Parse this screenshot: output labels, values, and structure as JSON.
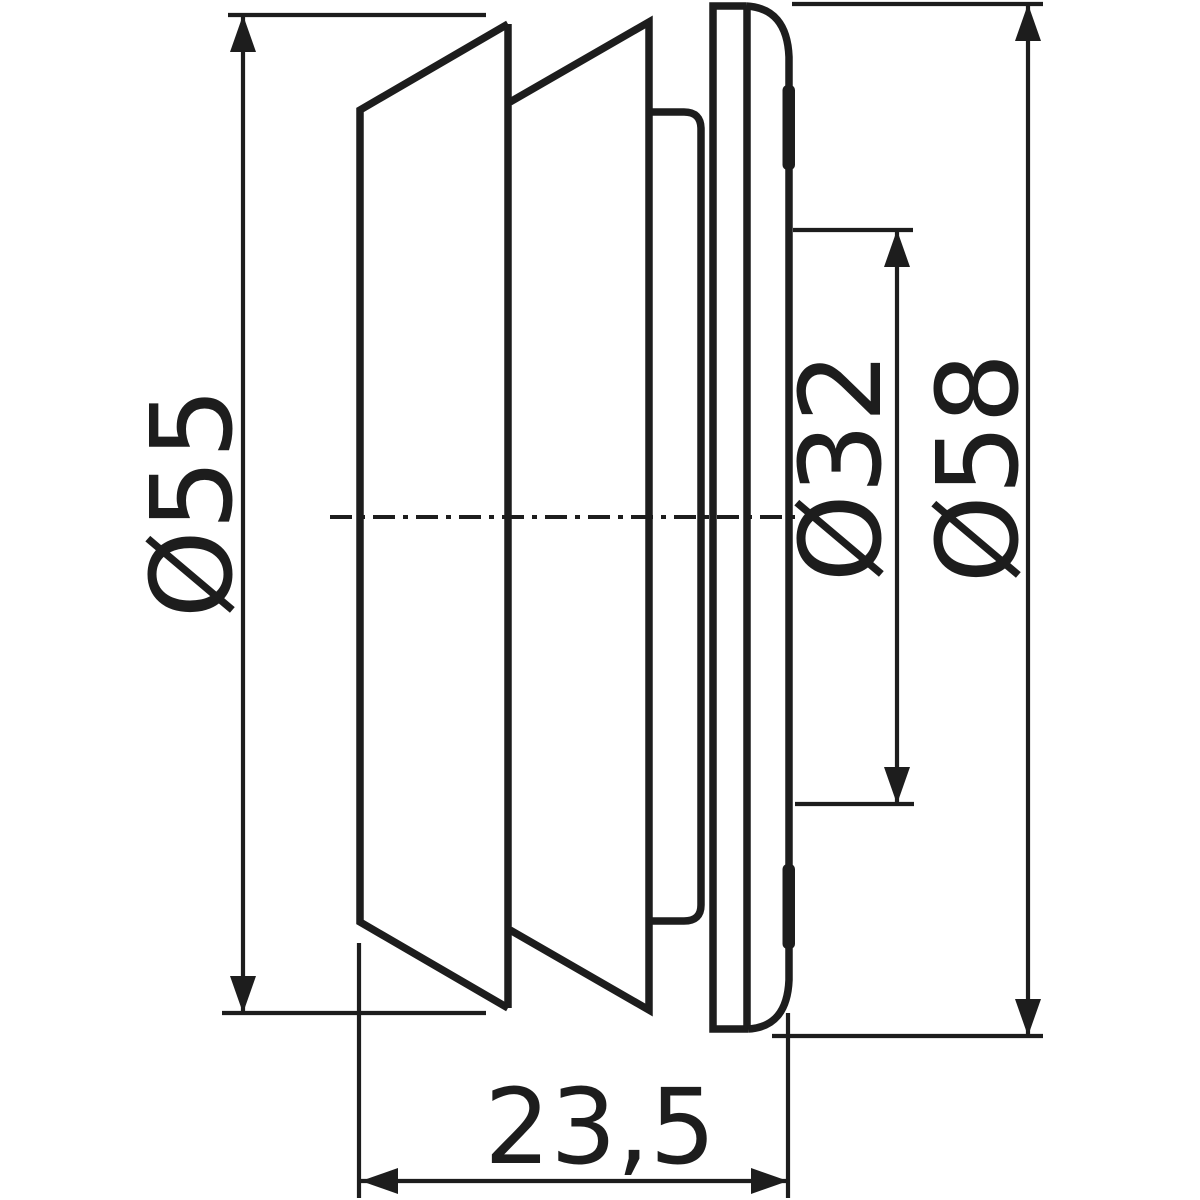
{
  "drawing": {
    "type": "technical-dimension-drawing",
    "background_color": "#ffffff",
    "line_color": "#1d1d1d",
    "view": "side-profile-of-round-reduction-insert",
    "dimensions": {
      "d55": {
        "label": "Ø55"
      },
      "d32": {
        "label": "Ø32"
      },
      "d58": {
        "label": "Ø58"
      },
      "depth": {
        "label": "23,5"
      }
    }
  }
}
